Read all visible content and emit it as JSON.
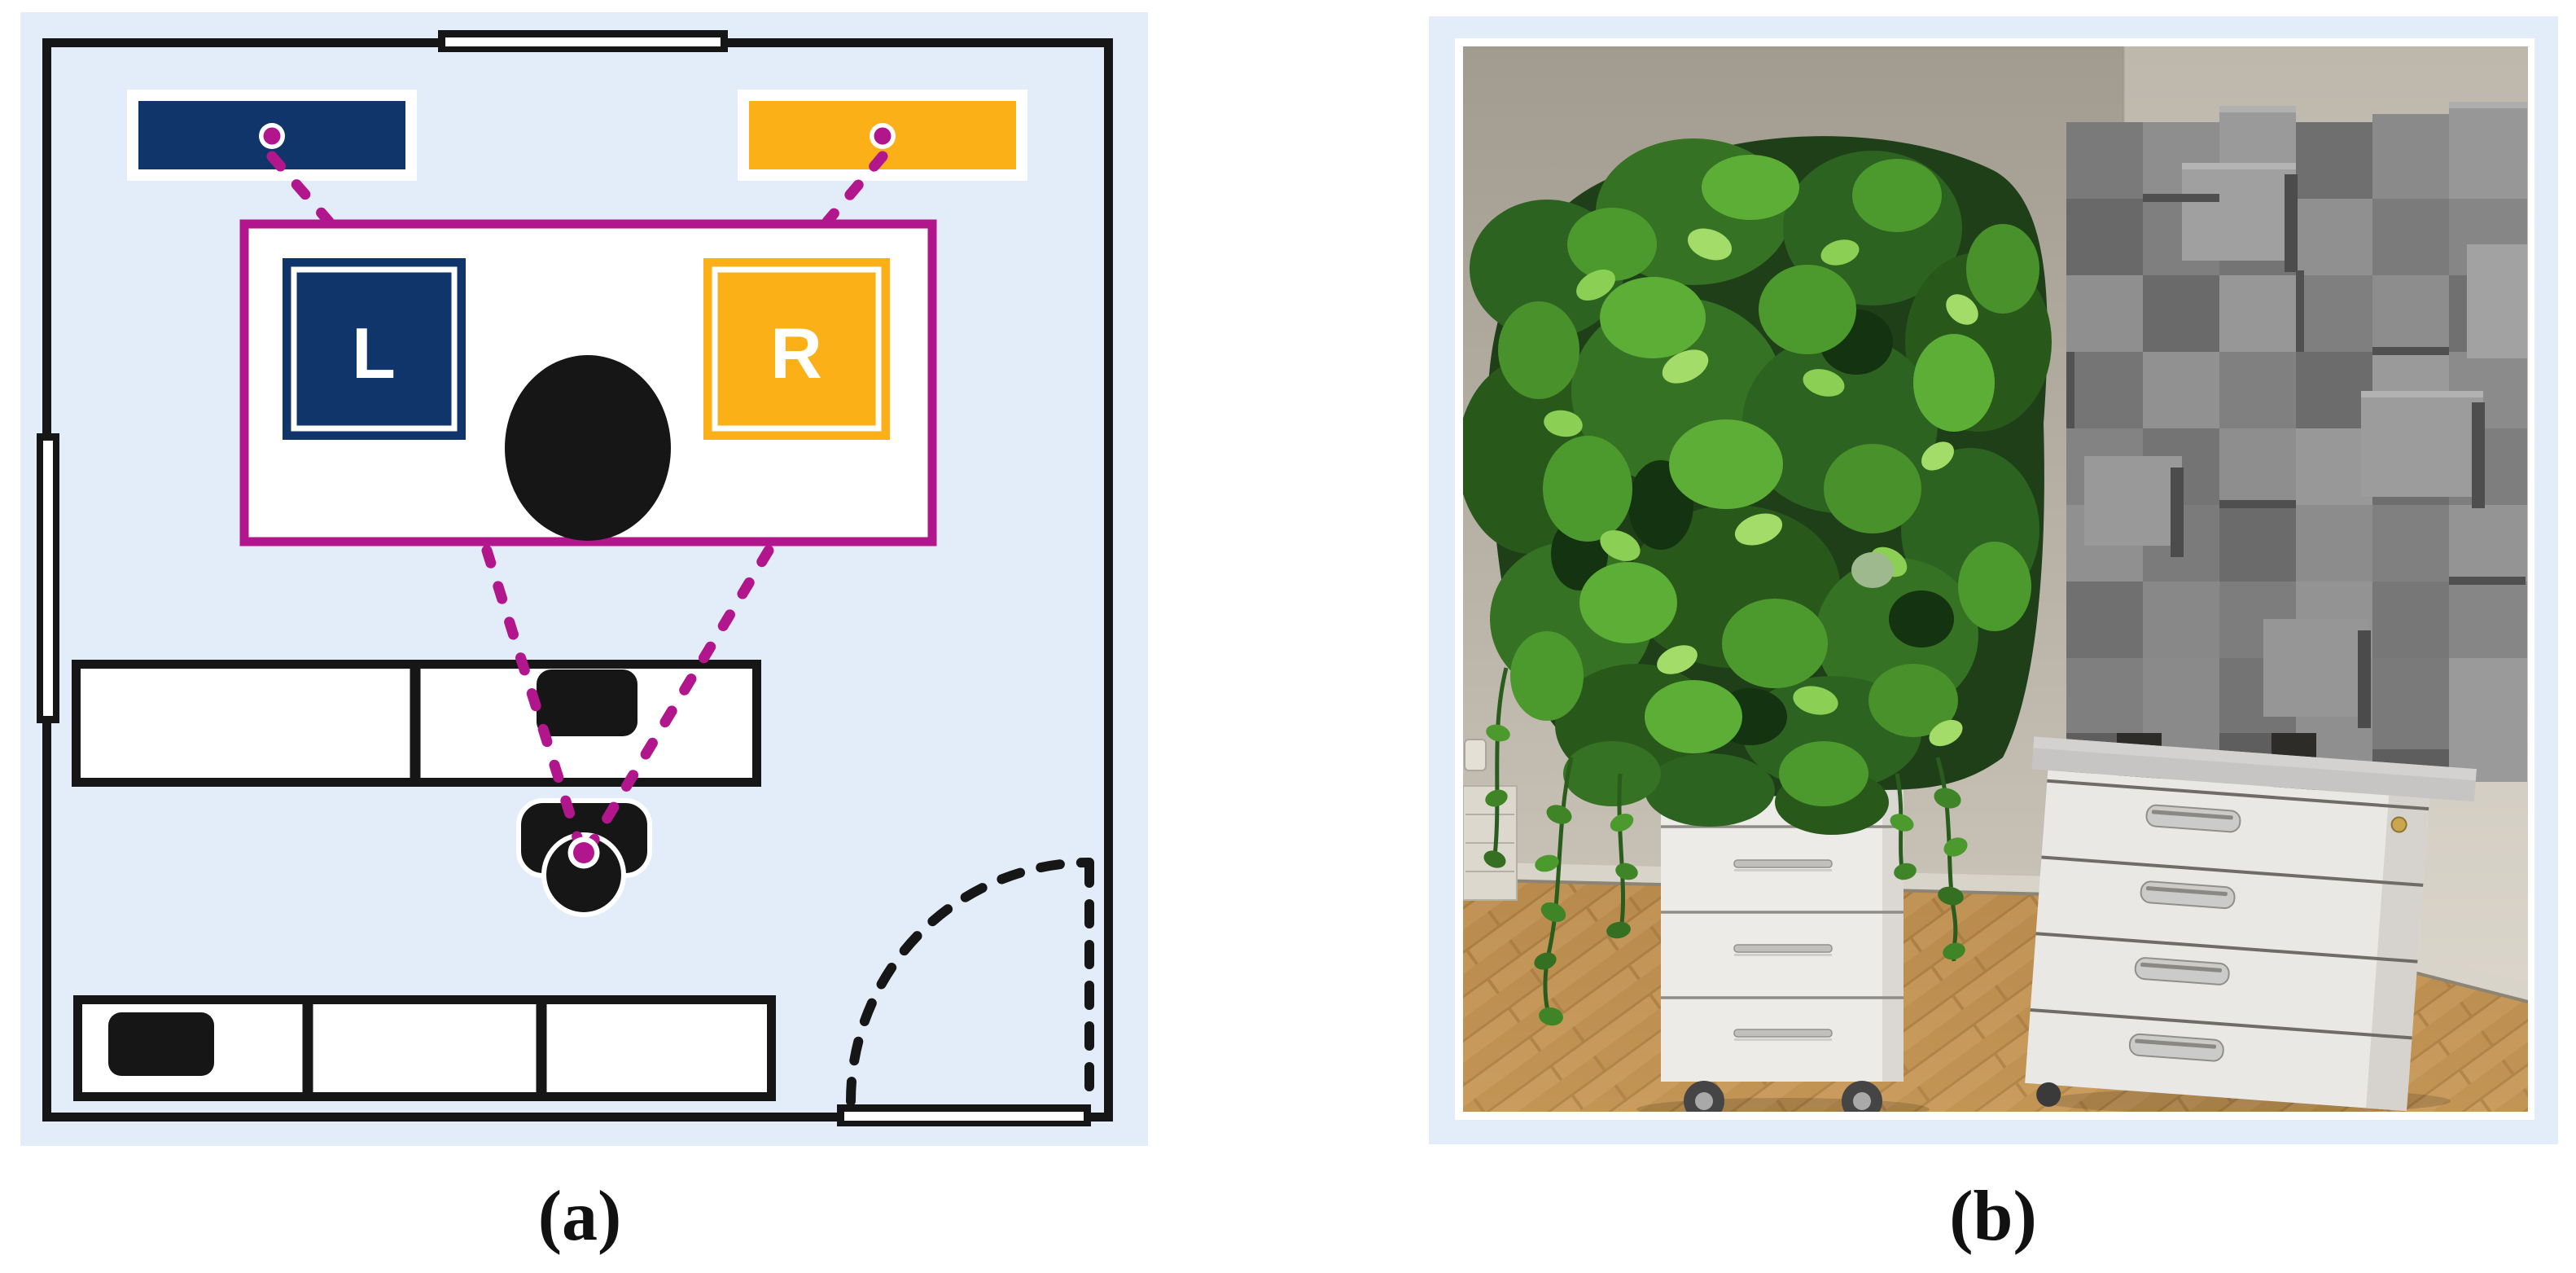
{
  "panels": {
    "a": {
      "caption": "(a)",
      "stage": {
        "left_label": "L",
        "right_label": "R"
      },
      "colors": {
        "room_background": "#e2edf9",
        "line_black": "#161616",
        "navy_speaker": "#10356b",
        "orange_speaker": "#fbb018",
        "magenta_marker": "#b2168c"
      }
    },
    "b": {
      "caption": "(b)",
      "colors": {
        "frame_blue": "#e2edf9",
        "photo_wall": "#b5afa4",
        "photo_floor": "#c0924f",
        "plant_green": "#3a7d27",
        "diffuser_gray": "#7d7d7d",
        "cabinet_white": "#eae8e4"
      }
    }
  }
}
